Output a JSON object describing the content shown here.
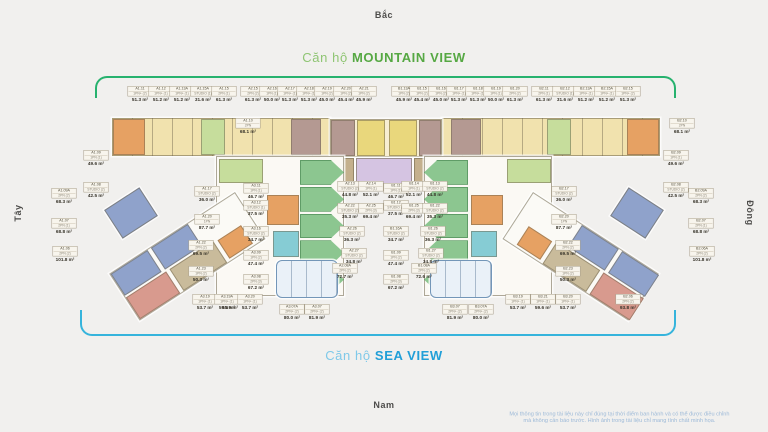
{
  "compass": {
    "north": "Bắc",
    "south": "Nam",
    "west": "Tây",
    "east": "Đông"
  },
  "titles": {
    "mountain": {
      "prefix": "Căn hộ ",
      "name": "MOUNTAIN VIEW",
      "prefix_color": "#8fc573",
      "name_color": "#56a843"
    },
    "sea": {
      "prefix": "Căn hộ ",
      "name": "SEA VIEW",
      "prefix_color": "#7fc9e9",
      "name_color": "#219fd8"
    }
  },
  "brackets": {
    "mountain_color": "#27b26e",
    "sea_color": "#36b4dc"
  },
  "disclaimer": {
    "line1": "Mọi thông tin trong tài liệu này chỉ đúng tại thời điểm ban hành và có thể được điều chỉnh",
    "line2": "mà không cần báo trước. Hình ảnh trong tài liệu chỉ mang tính chất minh họa."
  },
  "unit_labels": [
    {
      "code": "A1.11",
      "type": "1PN+ (2)",
      "area": "51.3 m²",
      "x": 140,
      "y": 86
    },
    {
      "code": "A1.12",
      "type": "1PN+ (1)",
      "area": "51.2 m²",
      "x": 161,
      "y": 86
    },
    {
      "code": "A1.13A",
      "type": "1PN+ (1)",
      "area": "51.2 m²",
      "x": 182,
      "y": 86
    },
    {
      "code": "A1.15A",
      "type": "STUDIO (1)",
      "area": "31.6 m²",
      "x": 203,
      "y": 86
    },
    {
      "code": "A1.15",
      "type": "2PN (1)",
      "area": "61.3 m²",
      "x": 224,
      "y": 86
    },
    {
      "code": "A2.15",
      "type": "2PN (2)",
      "area": "61.3 m²",
      "x": 253,
      "y": 86
    },
    {
      "code": "A2.16",
      "type": "1PN (1)",
      "area": "50.0 m²",
      "x": 272,
      "y": 86
    },
    {
      "code": "A2.17",
      "type": "1PN+ (1)",
      "area": "51.3 m²",
      "x": 290,
      "y": 86
    },
    {
      "code": "A2.18",
      "type": "1PN+ (1)",
      "area": "51.3 m²",
      "x": 309,
      "y": 86
    },
    {
      "code": "A2.19",
      "type": "1PN (2)",
      "area": "45.0 m²",
      "x": 327,
      "y": 86
    },
    {
      "code": "A2.20",
      "type": "1PN (2)",
      "area": "45.4 m²",
      "x": 346,
      "y": 86
    },
    {
      "code": "A2.21",
      "type": "1PN (2)",
      "area": "45.9 m²",
      "x": 364,
      "y": 86
    },
    {
      "code": "B1.13A",
      "type": "1PN (2)",
      "area": "45.9 m²",
      "x": 404,
      "y": 86
    },
    {
      "code": "B1.15",
      "type": "1PN (2)",
      "area": "45.4 m²",
      "x": 422,
      "y": 86
    },
    {
      "code": "B1.16",
      "type": "1PN (2)",
      "area": "45.0 m²",
      "x": 441,
      "y": 86
    },
    {
      "code": "B1.17",
      "type": "1PN+ (1)",
      "area": "51.3 m²",
      "x": 459,
      "y": 86
    },
    {
      "code": "B1.18",
      "type": "1PN+ (1)",
      "area": "51.3 m²",
      "x": 478,
      "y": 86
    },
    {
      "code": "B1.19",
      "type": "1PN (1)",
      "area": "50.0 m²",
      "x": 496,
      "y": 86
    },
    {
      "code": "B1.20",
      "type": "2PN (2)",
      "area": "61.3 m²",
      "x": 515,
      "y": 86
    },
    {
      "code": "B2.11",
      "type": "2PN (1)",
      "area": "61.3 m²",
      "x": 544,
      "y": 86
    },
    {
      "code": "B2.12",
      "type": "STUDIO (1)",
      "area": "31.6 m²",
      "x": 565,
      "y": 86
    },
    {
      "code": "B2.13A",
      "type": "1PN+ (1)",
      "area": "51.2 m²",
      "x": 586,
      "y": 86
    },
    {
      "code": "B2.15A",
      "type": "1PN+ (1)",
      "area": "51.2 m²",
      "x": 607,
      "y": 86
    },
    {
      "code": "B2.15",
      "type": "1PN+ (2)",
      "area": "51.3 m²",
      "x": 628,
      "y": 86
    },
    {
      "code": "A1.10",
      "type": "2PN",
      "area": "68.1 m²",
      "x": 248,
      "y": 118
    },
    {
      "code": "A1.09",
      "type": "1PN (1)",
      "area": "49.6 m²",
      "x": 96,
      "y": 150
    },
    {
      "code": "A1.08",
      "type": "STUDIO (2)",
      "area": "42.5 m²",
      "x": 96,
      "y": 182
    },
    {
      "code": "A1.09A",
      "type": "2PN (2)",
      "area": "68.3 m²",
      "x": 64,
      "y": 188
    },
    {
      "code": "A1.07",
      "type": "2PN (1)",
      "area": "68.8 m²",
      "x": 64,
      "y": 218
    },
    {
      "code": "A1.06",
      "type": "2PN (2)",
      "area": "101.8 m²",
      "x": 65,
      "y": 246
    },
    {
      "code": "A1.06A",
      "type": "2PN (2)",
      "area": "95.9 m²",
      "x": 230,
      "y": 294
    },
    {
      "code": "B2.10",
      "type": "2PN",
      "area": "68.1 m²",
      "x": 682,
      "y": 118
    },
    {
      "code": "B2.09",
      "type": "1PN (1)",
      "area": "49.6 m²",
      "x": 676,
      "y": 150
    },
    {
      "code": "B2.08",
      "type": "STUDIO (2)",
      "area": "42.5 m²",
      "x": 676,
      "y": 182
    },
    {
      "code": "B2.09A",
      "type": "2PN (2)",
      "area": "68.3 m²",
      "x": 701,
      "y": 188
    },
    {
      "code": "B2.07",
      "type": "2PN (1)",
      "area": "68.8 m²",
      "x": 701,
      "y": 218
    },
    {
      "code": "B2.06A",
      "type": "2PN (2)",
      "area": "101.8 m²",
      "x": 702,
      "y": 246
    },
    {
      "code": "B2.06",
      "type": "2PN (2)",
      "area": "93.8 m²",
      "x": 628,
      "y": 294
    },
    {
      "code": "A1.17",
      "type": "STUDIO (2)",
      "area": "36.0 m²",
      "x": 207,
      "y": 186
    },
    {
      "code": "A1.20",
      "type": "1PN",
      "area": "87.7 m²",
      "x": 207,
      "y": 214
    },
    {
      "code": "A1.22",
      "type": "2PN (2)",
      "area": "69.5 m²",
      "x": 201,
      "y": 240
    },
    {
      "code": "A1.23",
      "type": "1PN (2)",
      "area": "50.3 m²",
      "x": 201,
      "y": 266
    },
    {
      "code": "A3.11",
      "type": "1PN (1)",
      "area": "46.7 m²",
      "x": 256,
      "y": 183
    },
    {
      "code": "A3.12",
      "type": "STUDIO (1)",
      "area": "37.5 m²",
      "x": 256,
      "y": 200
    },
    {
      "code": "A3.16",
      "type": "STUDIO (2)",
      "area": "34.7 m²",
      "x": 256,
      "y": 226
    },
    {
      "code": "A3.09",
      "type": "1PN (2)",
      "area": "47.4 m²",
      "x": 256,
      "y": 250
    },
    {
      "code": "A3.08",
      "type": "2PN (3)",
      "area": "67.2 m²",
      "x": 256,
      "y": 274
    },
    {
      "code": "B1.11",
      "type": "1PN (1)",
      "area": "46.7 m²",
      "x": 396,
      "y": 183
    },
    {
      "code": "B1.12",
      "type": "STUDIO (1)",
      "area": "37.5 m²",
      "x": 396,
      "y": 200
    },
    {
      "code": "B1.16A",
      "type": "STUDIO (2)",
      "area": "34.7 m²",
      "x": 396,
      "y": 226
    },
    {
      "code": "B1.09",
      "type": "1PN (2)",
      "area": "47.4 m²",
      "x": 396,
      "y": 250
    },
    {
      "code": "B1.08",
      "type": "2PN (3)",
      "area": "67.2 m²",
      "x": 396,
      "y": 274
    },
    {
      "code": "B2.17",
      "type": "STUDIO (2)",
      "area": "36.0 m²",
      "x": 564,
      "y": 186
    },
    {
      "code": "B2.20",
      "type": "1PN",
      "area": "87.7 m²",
      "x": 564,
      "y": 214
    },
    {
      "code": "B2.22",
      "type": "2PN (2)",
      "area": "69.5 m²",
      "x": 568,
      "y": 240
    },
    {
      "code": "B2.23",
      "type": "1PN (2)",
      "area": "50.3 m²",
      "x": 568,
      "y": 266
    },
    {
      "code": "A2.13",
      "type": "STUDIO (2)",
      "area": "44.8 m²",
      "x": 350,
      "y": 181
    },
    {
      "code": "A2.14",
      "type": "1PN (1)",
      "area": "52.1 m²",
      "x": 371,
      "y": 181
    },
    {
      "code": "B1.14",
      "type": "1PN (1)",
      "area": "52.1 m²",
      "x": 414,
      "y": 181
    },
    {
      "code": "B1.13",
      "type": "STUDIO (2)",
      "area": "44.8 m²",
      "x": 435,
      "y": 181
    },
    {
      "code": "A2.22",
      "type": "STUDIO (2)",
      "area": "35.3 m²",
      "x": 350,
      "y": 203
    },
    {
      "code": "A2.25",
      "type": "2PN (3)",
      "area": "69.4 m²",
      "x": 371,
      "y": 203
    },
    {
      "code": "B1.25",
      "type": "2PN (3)",
      "area": "69.4 m²",
      "x": 414,
      "y": 203
    },
    {
      "code": "B1.22",
      "type": "STUDIO (2)",
      "area": "35.3 m²",
      "x": 435,
      "y": 203
    },
    {
      "code": "A2.26",
      "type": "STUDIO (2)",
      "area": "36.3 m²",
      "x": 352,
      "y": 226
    },
    {
      "code": "B1.26",
      "type": "STUDIO (2)",
      "area": "36.3 m²",
      "x": 433,
      "y": 226
    },
    {
      "code": "A2.27",
      "type": "STUDIO (2)",
      "area": "34.8 m²",
      "x": 354,
      "y": 248
    },
    {
      "code": "B1.27",
      "type": "STUDIO (2)",
      "area": "34.8 m²",
      "x": 431,
      "y": 248
    },
    {
      "code": "A2.08A",
      "type": "2PN (2)",
      "area": "72.7 m²",
      "x": 345,
      "y": 263
    },
    {
      "code": "B1.08A",
      "type": "2PN (2)",
      "area": "72.6 m²",
      "x": 424,
      "y": 263
    },
    {
      "code": "A3.19",
      "type": "1PN+ (1)",
      "area": "53.7 m²",
      "x": 205,
      "y": 294
    },
    {
      "code": "A3.19A",
      "type": "1PN+ (1)",
      "area": "59.9 m²",
      "x": 227,
      "y": 294
    },
    {
      "code": "A3.20",
      "type": "1PN+ (1)",
      "area": "53.7 m²",
      "x": 250,
      "y": 294
    },
    {
      "code": "A3.07A",
      "type": "2PN+ (2)",
      "area": "80.0 m²",
      "x": 292,
      "y": 304
    },
    {
      "code": "A3.07",
      "type": "2PN+ (2)",
      "area": "81.9 m²",
      "x": 317,
      "y": 304
    },
    {
      "code": "B3.07",
      "type": "2PN+ (2)",
      "area": "81.9 m²",
      "x": 455,
      "y": 304
    },
    {
      "code": "B3.07A",
      "type": "2PN+ (2)",
      "area": "80.0 m²",
      "x": 481,
      "y": 304
    },
    {
      "code": "B3.19",
      "type": "1PN+ (1)",
      "area": "53.7 m²",
      "x": 518,
      "y": 294
    },
    {
      "code": "B3.21",
      "type": "1PN+ (1)",
      "area": "59.6 m²",
      "x": 543,
      "y": 294
    },
    {
      "code": "B3.20",
      "type": "1PN+ (1)",
      "area": "53.7 m²",
      "x": 568,
      "y": 294
    }
  ]
}
